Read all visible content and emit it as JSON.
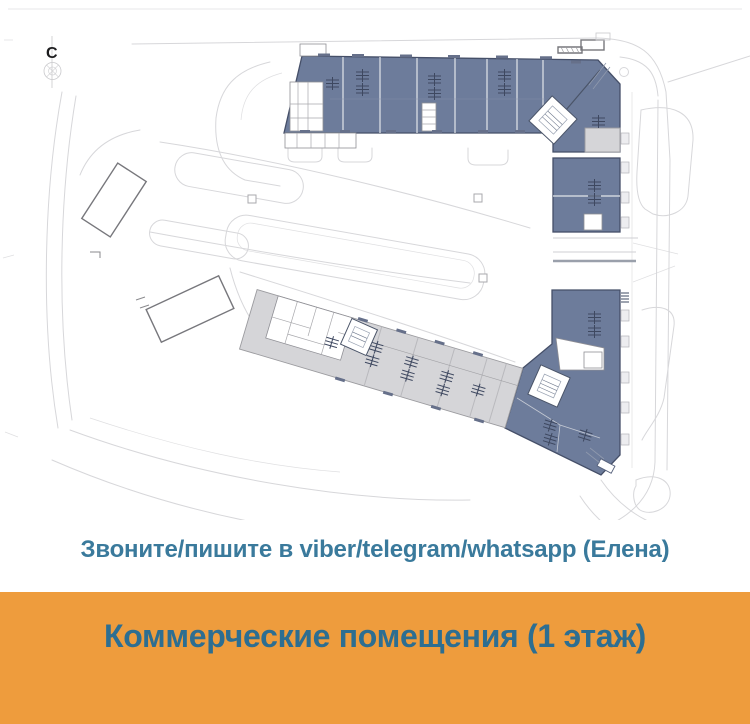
{
  "compass": {
    "label": "С"
  },
  "contact": {
    "text": "Звоните/пишите в viber/telegram/whatsapp (Елена)"
  },
  "banner": {
    "text": "Коммерческие помещения (1 этаж)"
  },
  "plan": {
    "description": "site-plan-first-floor-commercial-units",
    "upper_building_units_color_meaning": "commercial premises",
    "lower_building_parking_color_meaning": "parking / technical"
  },
  "theme": {
    "unit_fill": "#6d7c9b",
    "unit_stroke": "#454f68",
    "parking_fill": "#d5d5d8",
    "parking_stroke": "#9b9b9f",
    "road_stroke": "#d7d7da",
    "contact_text_color": "#3a7a9c",
    "banner_background": "#ee9c3d",
    "banner_text_color": "#2d6e91"
  }
}
